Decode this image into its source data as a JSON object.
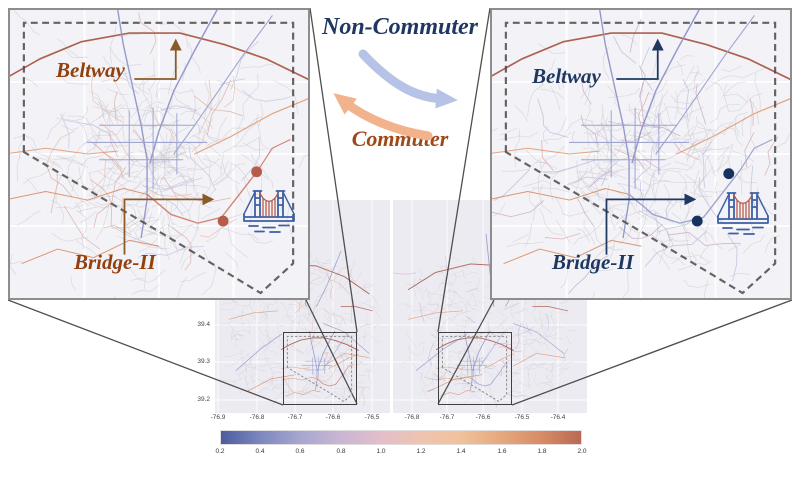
{
  "figure": {
    "center": {
      "non_commuter_label": "Non-Commuter",
      "commuter_label": "Commuter",
      "non_commuter_color": "#1e3862",
      "commuter_color": "#a04818",
      "blue_arrow_color": "#b7c3e6",
      "orange_arrow_color": "#f2b28c"
    },
    "panels": {
      "left": {
        "beltway_label": "Beltway",
        "bridge_label": "Bridge-II",
        "label_color": "#93400f",
        "arrow_color": "#8a5a28",
        "dot_color": "#b65c4a",
        "bridge_route_color": "#cf8070"
      },
      "right": {
        "beltway_label": "Beltway",
        "bridge_label": "Bridge-II",
        "label_color": "#1e3862",
        "arrow_color": "#1e3862",
        "dot_color": "#16335f",
        "bridge_route_color": "#9aa0cc"
      }
    },
    "minimaps": {
      "left": {
        "y_ticks": [
          "39.4",
          "39.3",
          "39.2"
        ],
        "x_ticks": [
          "-76.9",
          "-76.8",
          "-76.7",
          "-76.6",
          "-76.5"
        ]
      },
      "right": {
        "x_ticks": [
          "-76.8",
          "-76.7",
          "-76.6",
          "-76.5",
          "-76.4"
        ]
      }
    },
    "colorbar": {
      "ticks": [
        "0.2",
        "0.4",
        "0.6",
        "0.8",
        "1.0",
        "1.2",
        "1.4",
        "1.6",
        "1.8",
        "2.0"
      ],
      "gradient_stops": [
        "#4d5c9e",
        "#7d88bf",
        "#a8a7cf",
        "#c9b6d3",
        "#e2bfc9",
        "#eec4b0",
        "#f0c29b",
        "#e6a87e",
        "#d78c66",
        "#ba6952"
      ]
    },
    "map_palette": {
      "background": "#f3f2f6",
      "minor": "#c7c7ce",
      "beltway": "#a85848",
      "purple": "#8d93c9",
      "purple_light": "#9aa0d0",
      "orange": "#e2a079",
      "orange_deep": "#d8906a",
      "boundary": "#4a4a4a",
      "bridge_icon_blue": "#3d5fa5",
      "bridge_icon_red": "#b85c4a",
      "connector": "#4f4f4f"
    }
  }
}
